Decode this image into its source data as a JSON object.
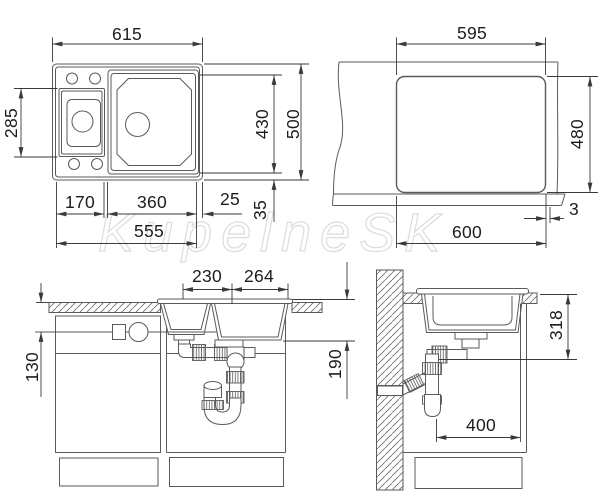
{
  "watermark": "KupelneSK",
  "colors": {
    "line": "#5a5a5a",
    "dimension": "#3a3a3a",
    "text": "#1c1c1c",
    "watermark": "#dcdcdc",
    "background": "#ffffff"
  },
  "views": {
    "top": {
      "name": "sink-top-view",
      "overall_width": "615",
      "left_bowl_depth": "285",
      "main_bowl_length": "430",
      "overall_depth": "500",
      "left_bowl_width": "170",
      "main_bowl_width": "360",
      "right_margin": "25",
      "bottom_margin": "35",
      "base_width": "555"
    },
    "cutout": {
      "name": "countertop-cutout-view",
      "cutout_width": "595",
      "cutout_depth": "480",
      "counter_width": "600",
      "edge_gap": "3"
    },
    "front": {
      "name": "front-elevation-view",
      "left_bowl_width": "230",
      "right_bowl_width": "264",
      "connection_height": "130",
      "drain_height": "190"
    },
    "side": {
      "name": "side-section-view",
      "bowl_depth_height": "318",
      "rear_clearance": "400"
    }
  }
}
